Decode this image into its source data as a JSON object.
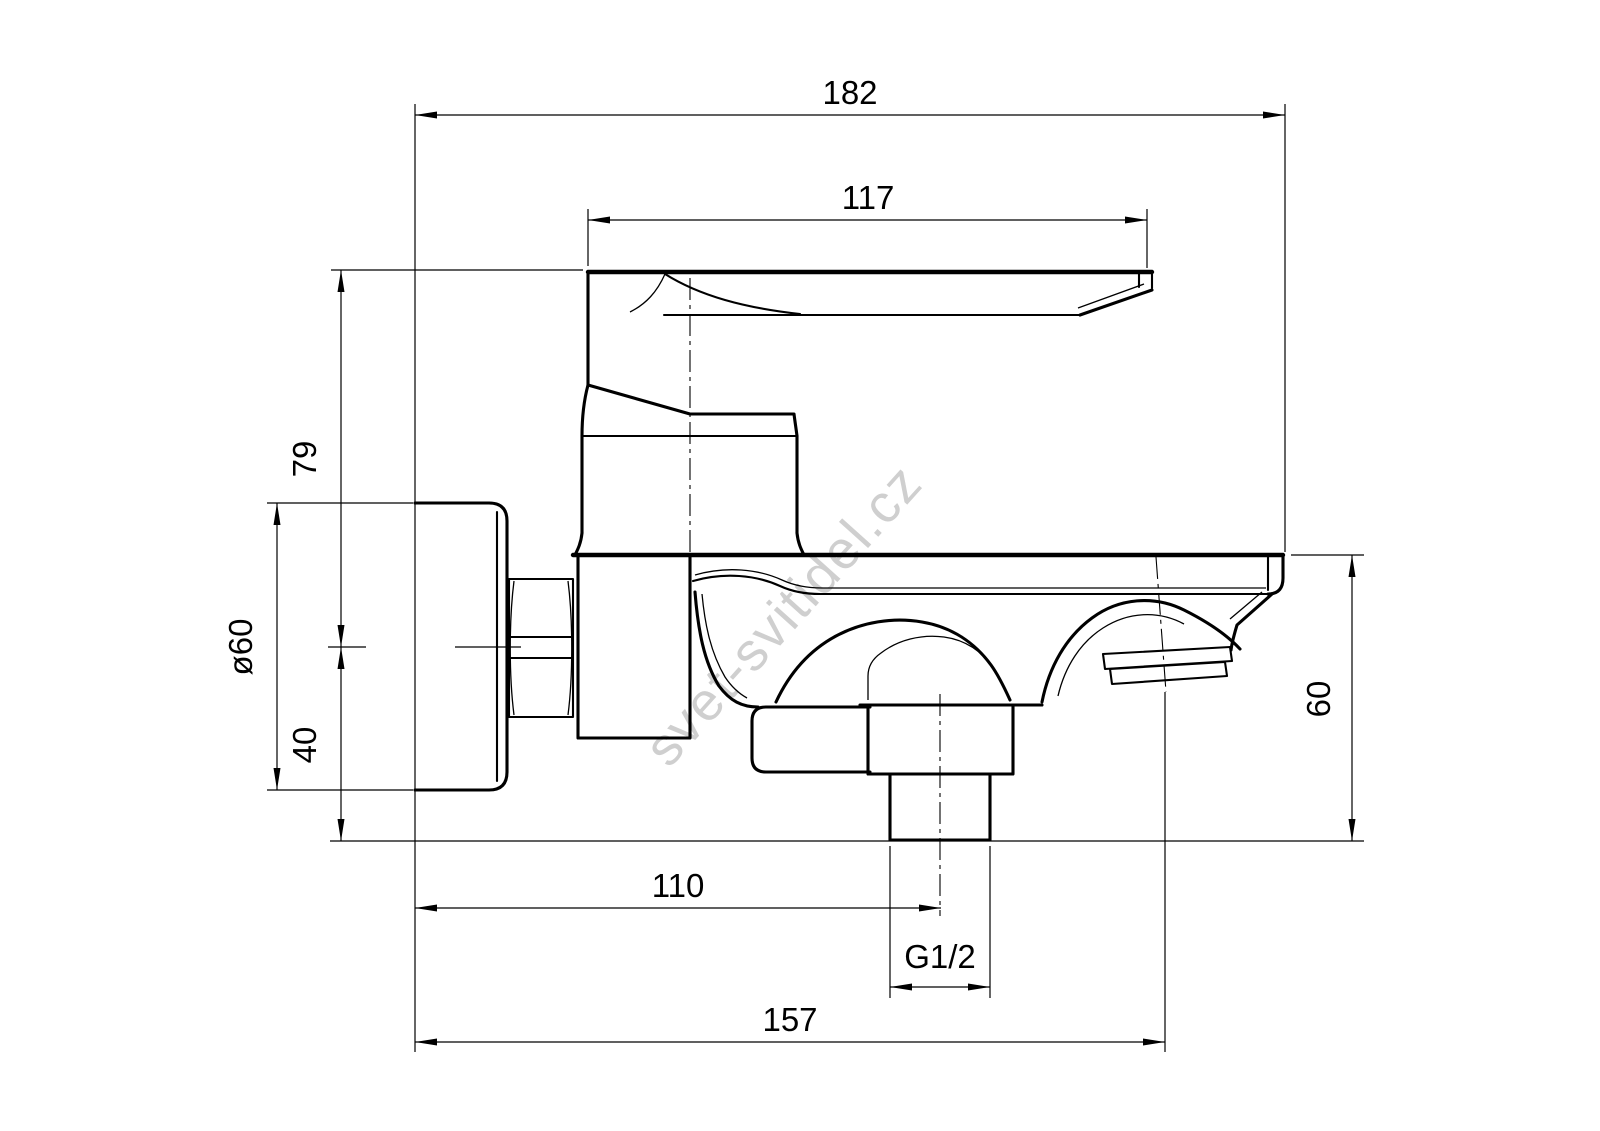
{
  "drawing": {
    "type": "technical-dimension-drawing",
    "subject": "wall-mounted bath mixer faucet, side view",
    "watermark": "svet-svitidel.cz",
    "colors": {
      "line": "#000000",
      "background": "#ffffff",
      "watermark": "#cfcfcf"
    },
    "dimensions": {
      "overall_depth": "182",
      "handle_length": "117",
      "height_above_axis": "79",
      "flange_diameter": "ø60",
      "axis_to_outlet": "40",
      "spout_drop": "60",
      "wall_to_pipe_center": "110",
      "thread_size": "G1/2",
      "wall_to_spout_outlet": "157"
    }
  }
}
